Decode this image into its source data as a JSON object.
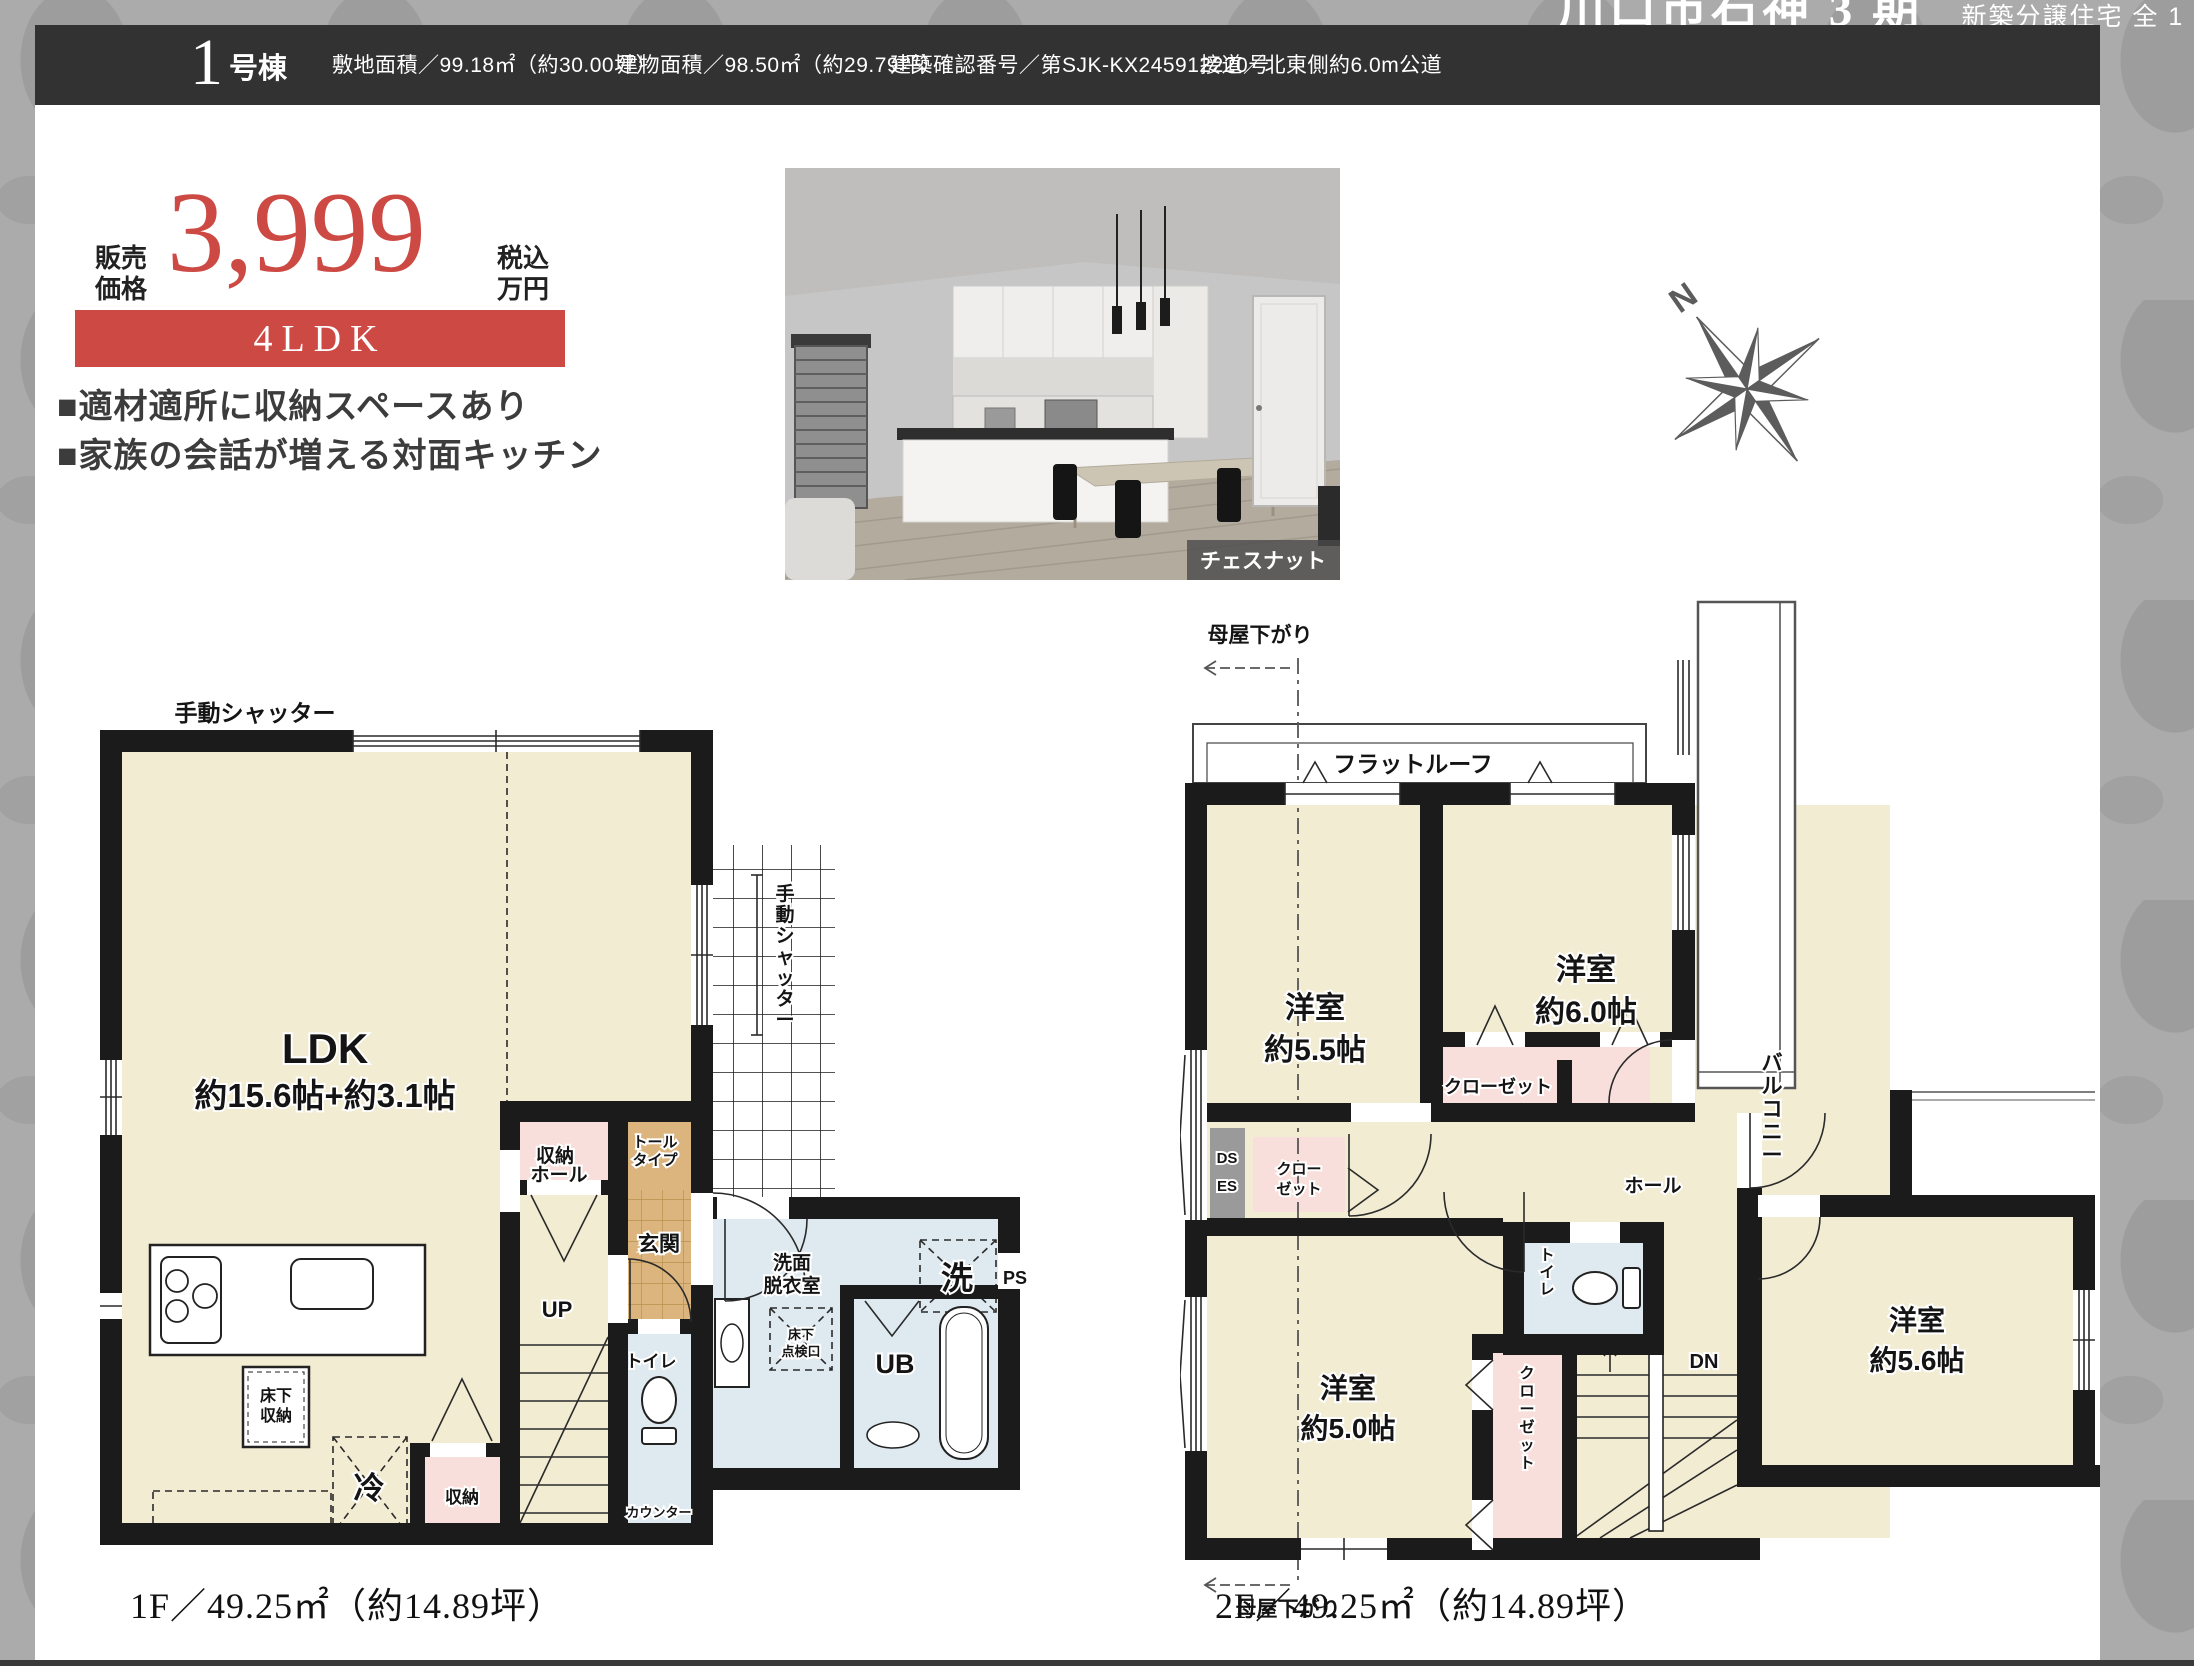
{
  "banner": {
    "title": "川口市石神 3 期",
    "subtitle": "新築分譲住宅 全 1 棟"
  },
  "header": {
    "unit_no": "1",
    "unit_suffix": "号棟",
    "specs": [
      "敷地面積／99.18㎡（約30.00坪）",
      "建物面積／98.50㎡（約29.79坪）",
      "建築確認番号／第SJK-KX245912220号",
      "接道／北東側約6.0m公道"
    ]
  },
  "price": {
    "label_line1": "販売",
    "label_line2": "価格",
    "value": "3,999",
    "unit_line1": "税込",
    "unit_line2": "万円",
    "layout": "4LDK"
  },
  "features": {
    "line1": "■適材適所に収納スペースあり",
    "line2": "■家族の会話が増える対面キッチン"
  },
  "photo": {
    "caption": "チェスナット"
  },
  "compass": {
    "north": "N"
  },
  "colors": {
    "accent": "#cd4a44",
    "header_bg": "#323232",
    "wall": "#1b1b1b",
    "room_cream": "#f2ecd3",
    "room_pink": "#f8dfdb",
    "room_blue": "#dfeaf0",
    "room_tan": "#dcb57e"
  },
  "floor1": {
    "shutter_top": "手動シャッター",
    "shutter_right": "手動シャッター",
    "ldk_line1": "LDK",
    "ldk_line2": "約15.6帖+約3.1帖",
    "storage_upper": "収納",
    "tall_type_line1": "トール",
    "tall_type_line2": "タイプ",
    "entrance": "玄関",
    "hall": "ホール",
    "stairs_up": "UP",
    "toilet": "トイレ",
    "counter": "カウンター",
    "washroom_line1": "洗面",
    "washroom_line2": "脱衣室",
    "inspection_line1": "床下",
    "inspection_line2": "点検口",
    "laundry": "洗",
    "pipe_space": "PS",
    "unit_bath": "UB",
    "underfloor_line1": "床下",
    "underfloor_line2": "収納",
    "fridge": "冷",
    "storage_lower": "収納",
    "area": "1F／49.25㎡（約14.89坪）"
  },
  "floor2": {
    "moyasagari_top": "母屋下がり",
    "moyasagari_bottom": "母屋下がり",
    "flat_roof": "フラットルーフ",
    "room55_line1": "洋室",
    "room55_line2": "約5.5帖",
    "room60_line1": "洋室",
    "room60_line2": "約6.0帖",
    "balcony": "バルコニー",
    "closet_top": "クローゼット",
    "ds": "DS",
    "es": "ES",
    "closet_left_line1": "クロー",
    "closet_left_line2": "ゼット",
    "hall": "ホール",
    "toilet": "トイレ",
    "closet_side": "クローゼット",
    "stairs_dn": "DN",
    "room50_line1": "洋室",
    "room50_line2": "約5.0帖",
    "room56_line1": "洋室",
    "room56_line2": "約5.6帖",
    "area": "2F／49.25㎡（約14.89坪）"
  }
}
